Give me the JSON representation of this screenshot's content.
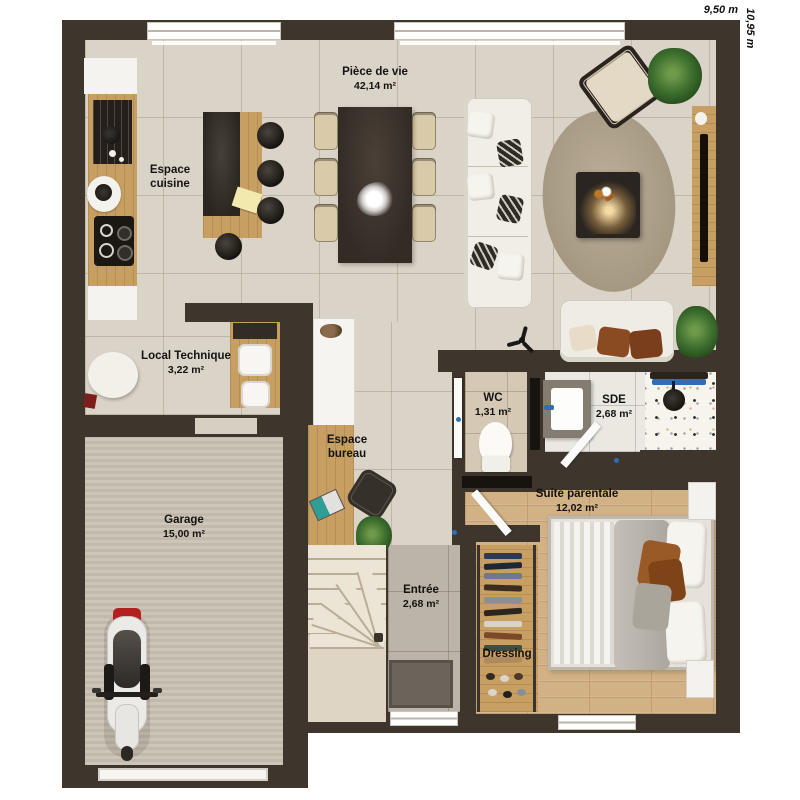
{
  "plan": {
    "dimensions": {
      "width_label": "9,50 m",
      "height_label": "10,95 m"
    },
    "rooms": [
      {
        "id": "piece_de_vie",
        "name": "Pièce de vie",
        "area": "42,14 m²"
      },
      {
        "id": "espace_cuisine",
        "name": "Espace cuisine",
        "area": ""
      },
      {
        "id": "local_technique",
        "name": "Local Technique",
        "area": "3,22 m²"
      },
      {
        "id": "garage",
        "name": "Garage",
        "area": "15,00 m²"
      },
      {
        "id": "espace_bureau",
        "name": "Espace bureau",
        "area": ""
      },
      {
        "id": "wc",
        "name": "WC",
        "area": "1,31 m²"
      },
      {
        "id": "sde",
        "name": "SDE",
        "area": "2,68 m²"
      },
      {
        "id": "suite_parentale",
        "name": "Suite parentale",
        "area": "12,02 m²"
      },
      {
        "id": "entree",
        "name": "Entrée",
        "area": "2,68 m²"
      },
      {
        "id": "dressing",
        "name": "Dressing",
        "area": ""
      }
    ],
    "colors": {
      "wall": "#3e362d",
      "living_floor": "#dad3c7",
      "bedroom_floor": "#d2b184",
      "garage_floor": "#c9c1b3",
      "kitchen_wood": "#c79f62",
      "rug": "#b3a58f",
      "sofa": "#f1eee7",
      "dark_furniture": "#352e27",
      "accent_blue": "#2f6db8",
      "accent_rust": "#8a4a22",
      "label_text": "#141311"
    }
  }
}
